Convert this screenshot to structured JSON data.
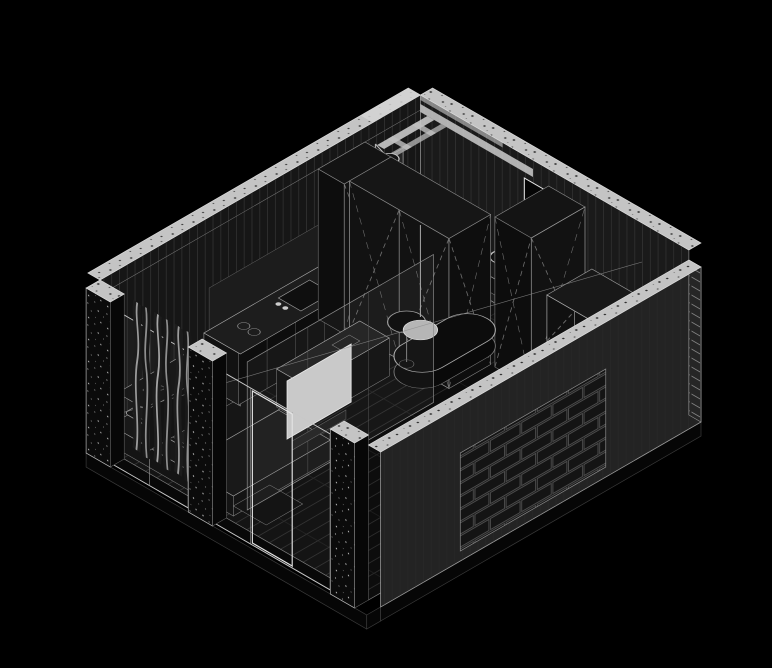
{
  "figure": {
    "type": "axonometric-cutaway-drawing",
    "subject": "studio apartment interior",
    "style": "technical white line work on black background",
    "projection": "isometric",
    "visible_text": ""
  },
  "colors": {
    "background": "#000000",
    "line": "#9a9a9a",
    "line_bright": "#dcdcdc",
    "line_dim": "#555555",
    "wall_face": "#161616",
    "wall_face_alt": "#1a1a1a",
    "front_wall": "#232323",
    "cut_band": "#c4c4c4",
    "concrete_dark": "#0b0b0b",
    "floor": "#0d0d0d",
    "furniture_dark": "#121212",
    "tv_screen": "#c9c9c9",
    "lamp_shade": "#b5b5b5",
    "brick_face": "#1e1e1e"
  },
  "components": {
    "walls": [
      "back-left wall with cut terrazzo band",
      "right wall with entry opening",
      "front-right brick wall",
      "concrete window piers"
    ],
    "furniture": [
      "kitchen counter",
      "tall cabinet",
      "wardrobe banks with X door symbols",
      "open shelving unit",
      "bed platform with mattress",
      "desk island",
      "round side table",
      "stadium dining table"
    ],
    "fixtures": [
      "shower head",
      "toilet",
      "vessel sink",
      "mirror",
      "floor drain",
      "pendant lamp",
      "tv panel",
      "curtains"
    ]
  }
}
